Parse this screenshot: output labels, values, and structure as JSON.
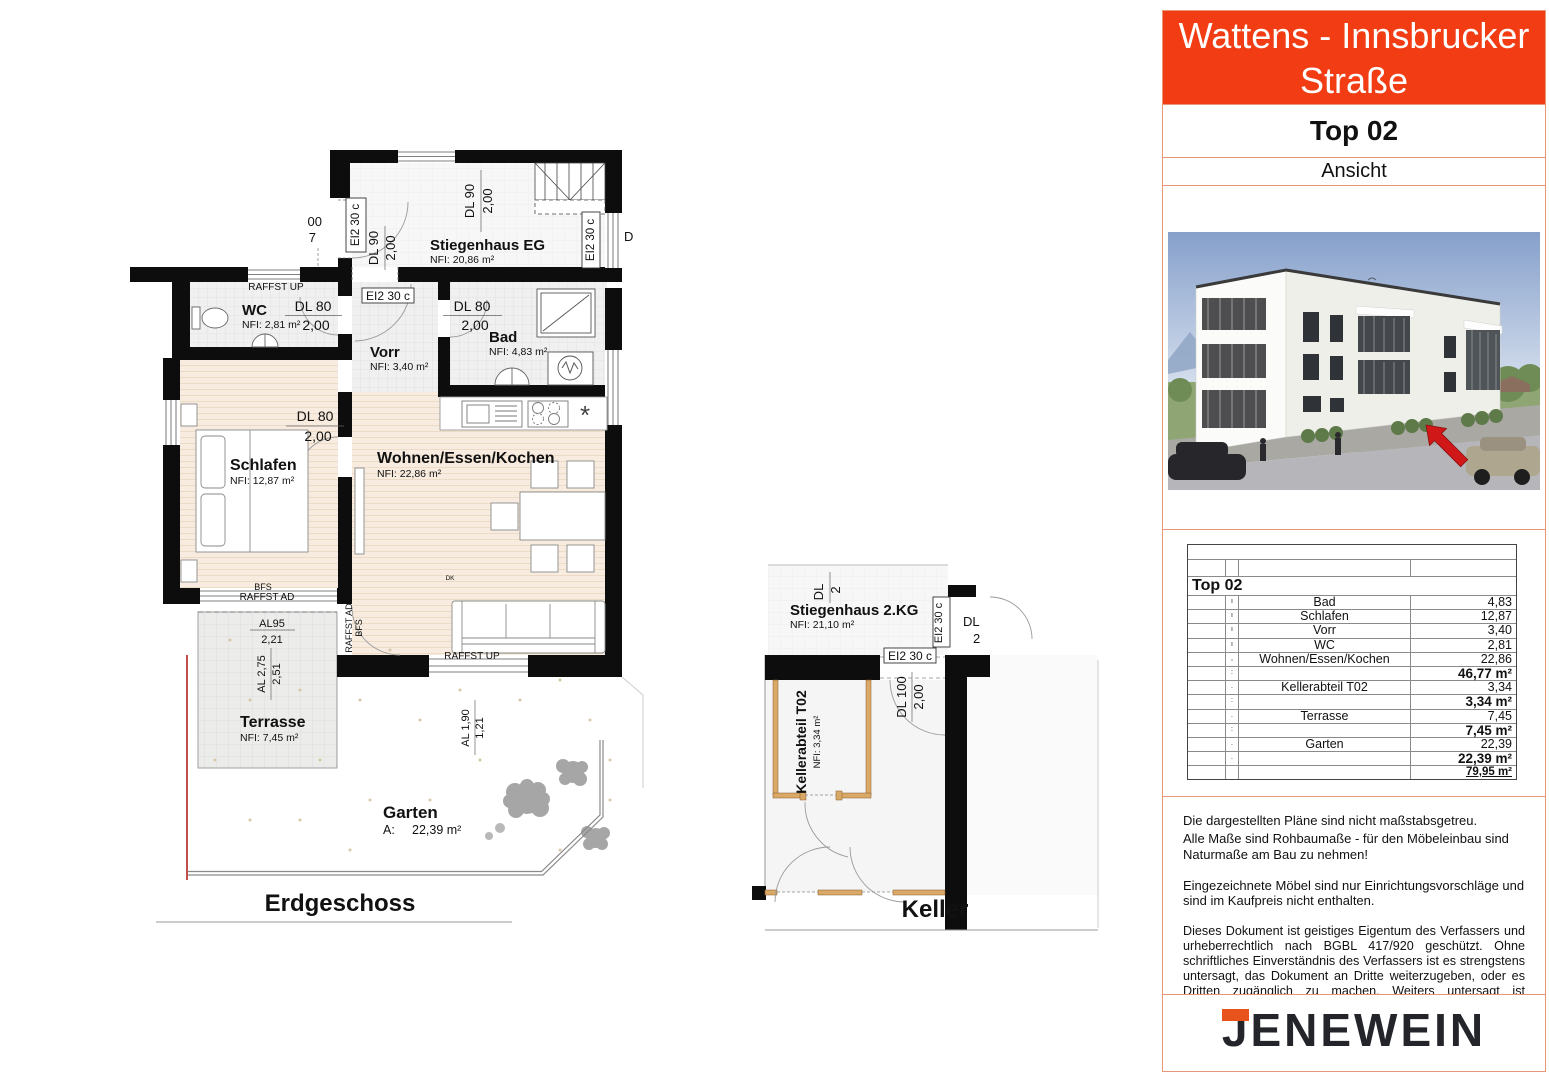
{
  "panel": {
    "title": "Wattens - Innsbrucker Straße",
    "unit": "Top 02",
    "view_label": "Ansicht"
  },
  "table": {
    "rows": [
      {
        "tick": "",
        "name": "",
        "value": ""
      },
      {
        "tick": "",
        "name": "",
        "value": ""
      },
      {
        "tick": "",
        "name": "Top 02",
        "value": ""
      },
      {
        "tick": "ı",
        "name": "Bad",
        "value": "4,83"
      },
      {
        "tick": "ı",
        "name": "Schlafen",
        "value": "12,87"
      },
      {
        "tick": "ı",
        "name": "Vorr",
        "value": "3,40"
      },
      {
        "tick": "ı",
        "name": "WC",
        "value": "2,81"
      },
      {
        "tick": ",",
        "name": "Wohnen/Essen/Kochen",
        "value": "22,86"
      },
      {
        "tick": ":",
        "name": "",
        "value": "46,77 m²"
      },
      {
        "tick": ".",
        "name": "Kellerabteil T02",
        "value": "3,34"
      },
      {
        "tick": ":",
        "name": "",
        "value": "3,34 m²"
      },
      {
        "tick": ".",
        "name": "Terrasse",
        "value": "7,45"
      },
      {
        "tick": ":",
        "name": "",
        "value": "7,45 m²"
      },
      {
        "tick": ".",
        "name": "Garten",
        "value": "22,39"
      },
      {
        "tick": ".",
        "name": "",
        "value": "22,39 m²"
      },
      {
        "tick": "",
        "name": "",
        "value": "79,95 m²"
      }
    ]
  },
  "notes": {
    "p1": "Die dargestellten Pläne sind nicht maßstabsgetreu.",
    "p2": "Alle Maße sind Rohbaumaße - für den Möbeleinbau sind Naturmaße am Bau zu nehmen!",
    "p3": "Eingezeichnete Möbel sind nur Einrichtungsvorschläge und sind im Kaufpreis nicht enthalten.",
    "p4": "Dieses Dokument ist geistiges Eigentum des Verfassers und urheberrechtlich nach BGBL 417/920 geschützt. Ohne schriftliches Einverständnis des Verfassers ist es strengstens untersagt, das Dokument an Dritte weiterzugeben, oder es Dritten zugänglich zu machen. Weiters untersagt ist Missbrauch oder Vervielfältigung des Dokuments! Farb- und Materialdarstellung kann geringfügig vom Angebot abweichen."
  },
  "logo": {
    "text": "JENEWEIN"
  },
  "plan_eg": {
    "title": "Erdgeschoss",
    "rooms": {
      "stiegenhaus": {
        "name": "Stiegenhaus EG",
        "area": "NFI: 20,86 m²"
      },
      "wc": {
        "name": "WC",
        "area": "NFI: 2,81 m²"
      },
      "vorr": {
        "name": "Vorr",
        "area": "NFI: 3,40 m²"
      },
      "bad": {
        "name": "Bad",
        "area": "NFI: 4,83 m²"
      },
      "schlafen": {
        "name": "Schlafen",
        "area": "NFI: 12,87 m²"
      },
      "wohnen": {
        "name": "Wohnen/Essen/Kochen",
        "area": "NFI: 22,86 m²"
      },
      "terrasse": {
        "name": "Terrasse",
        "area": "NFI: 7,45 m²"
      },
      "garten": {
        "name": "Garten",
        "area_prefix": "A:",
        "area": "22,39 m²"
      }
    },
    "dims": {
      "dl90": "DL 90",
      "dl80": "DL 80",
      "h200": "2,00",
      "ei2": "EI2 30 c",
      "raffst_up": "RAFFST UP",
      "raffst_ad": "RAFFST AD",
      "bfs": "BFS",
      "dk": "DK",
      "al95": "AL95",
      "v221": "2,21",
      "al275": "AL 2,75",
      "v251": "2,51",
      "al190": "AL 1,90",
      "v121": "1,21",
      "cut00": "00",
      "cut7": "7",
      "cutD": "D",
      "star": "*"
    }
  },
  "plan_kg": {
    "title": "Keller",
    "rooms": {
      "stiegenhaus": {
        "name": "Stiegenhaus 2.KG",
        "area": "NFI: 21,10 m²"
      },
      "kellerabteil": {
        "name": "Kellerabteil T02",
        "area": "NFI: 3,34 m²"
      }
    },
    "dims": {
      "dl100": "DL 100",
      "h200": "2,00",
      "ei2": "EI2 30 c",
      "cutDL": "DL",
      "cut2": "2"
    }
  }
}
